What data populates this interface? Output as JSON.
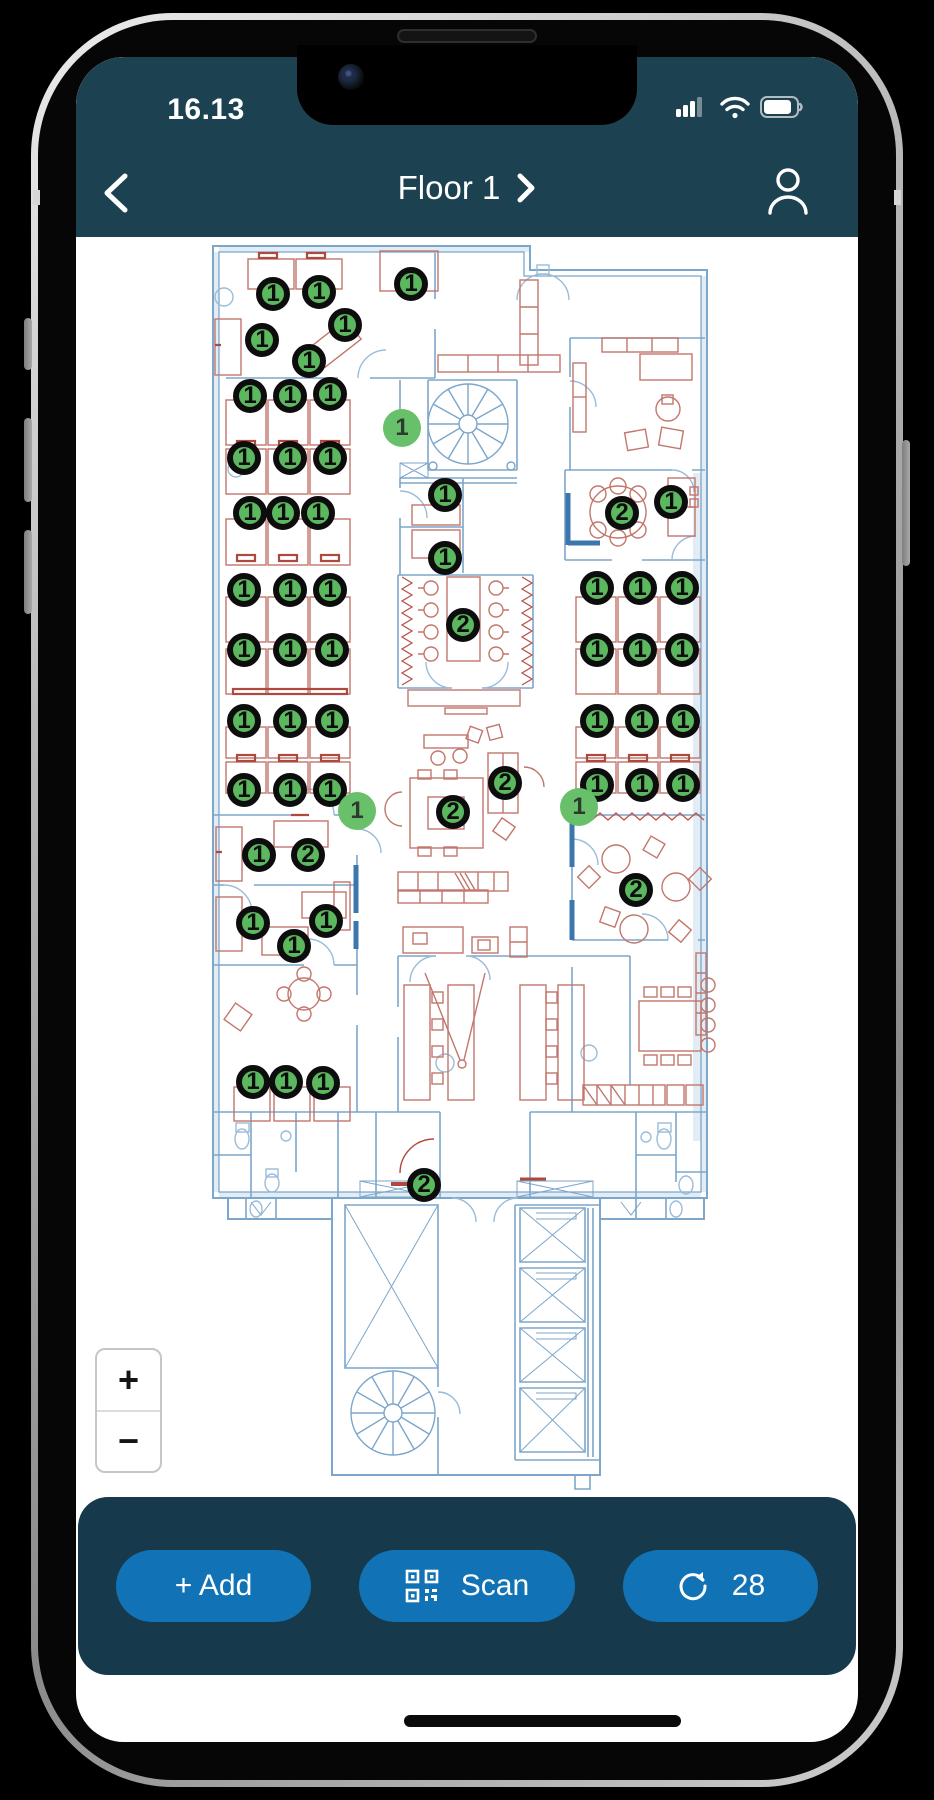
{
  "status_bar": {
    "time": "16.13",
    "cellular_bars": 3,
    "battery_percent": 80
  },
  "header": {
    "title": "Floor 1"
  },
  "map": {
    "zoom_in": "+",
    "zoom_out": "−",
    "markers": [
      {
        "x": 197,
        "y": 57,
        "label": "1",
        "variant": "ring"
      },
      {
        "x": 243,
        "y": 55,
        "label": "1",
        "variant": "ring"
      },
      {
        "x": 335,
        "y": 47,
        "label": "1",
        "variant": "ring"
      },
      {
        "x": 186,
        "y": 103,
        "label": "1",
        "variant": "ring"
      },
      {
        "x": 269,
        "y": 88,
        "label": "1",
        "variant": "ring"
      },
      {
        "x": 233,
        "y": 124,
        "label": "1",
        "variant": "ring"
      },
      {
        "x": 174,
        "y": 159,
        "label": "1",
        "variant": "ring"
      },
      {
        "x": 214,
        "y": 159,
        "label": "1",
        "variant": "ring"
      },
      {
        "x": 254,
        "y": 157,
        "label": "1",
        "variant": "ring"
      },
      {
        "x": 168,
        "y": 221,
        "label": "1",
        "variant": "ring"
      },
      {
        "x": 214,
        "y": 221,
        "label": "1",
        "variant": "ring"
      },
      {
        "x": 254,
        "y": 221,
        "label": "1",
        "variant": "ring"
      },
      {
        "x": 174,
        "y": 276,
        "label": "1",
        "variant": "ring"
      },
      {
        "x": 207,
        "y": 276,
        "label": "1",
        "variant": "ring"
      },
      {
        "x": 242,
        "y": 276,
        "label": "1",
        "variant": "ring"
      },
      {
        "x": 326,
        "y": 191,
        "label": "1",
        "variant": "plain"
      },
      {
        "x": 369,
        "y": 258,
        "label": "1",
        "variant": "ring"
      },
      {
        "x": 369,
        "y": 321,
        "label": "1",
        "variant": "ring"
      },
      {
        "x": 546,
        "y": 276,
        "label": "2",
        "variant": "ring"
      },
      {
        "x": 595,
        "y": 265,
        "label": "1",
        "variant": "ring"
      },
      {
        "x": 168,
        "y": 353,
        "label": "1",
        "variant": "ring"
      },
      {
        "x": 214,
        "y": 353,
        "label": "1",
        "variant": "ring"
      },
      {
        "x": 254,
        "y": 353,
        "label": "1",
        "variant": "ring"
      },
      {
        "x": 521,
        "y": 351,
        "label": "1",
        "variant": "ring"
      },
      {
        "x": 564,
        "y": 351,
        "label": "1",
        "variant": "ring"
      },
      {
        "x": 606,
        "y": 351,
        "label": "1",
        "variant": "ring"
      },
      {
        "x": 168,
        "y": 413,
        "label": "1",
        "variant": "ring"
      },
      {
        "x": 214,
        "y": 413,
        "label": "1",
        "variant": "ring"
      },
      {
        "x": 256,
        "y": 413,
        "label": "1",
        "variant": "ring"
      },
      {
        "x": 521,
        "y": 413,
        "label": "1",
        "variant": "ring"
      },
      {
        "x": 564,
        "y": 413,
        "label": "1",
        "variant": "ring"
      },
      {
        "x": 606,
        "y": 413,
        "label": "1",
        "variant": "ring"
      },
      {
        "x": 387,
        "y": 388,
        "label": "2",
        "variant": "ring"
      },
      {
        "x": 168,
        "y": 484,
        "label": "1",
        "variant": "ring"
      },
      {
        "x": 214,
        "y": 484,
        "label": "1",
        "variant": "ring"
      },
      {
        "x": 256,
        "y": 484,
        "label": "1",
        "variant": "ring"
      },
      {
        "x": 521,
        "y": 484,
        "label": "1",
        "variant": "ring"
      },
      {
        "x": 566,
        "y": 484,
        "label": "1",
        "variant": "ring"
      },
      {
        "x": 607,
        "y": 484,
        "label": "1",
        "variant": "ring"
      },
      {
        "x": 168,
        "y": 553,
        "label": "1",
        "variant": "ring"
      },
      {
        "x": 214,
        "y": 553,
        "label": "1",
        "variant": "ring"
      },
      {
        "x": 254,
        "y": 553,
        "label": "1",
        "variant": "ring"
      },
      {
        "x": 521,
        "y": 548,
        "label": "1",
        "variant": "ring"
      },
      {
        "x": 566,
        "y": 548,
        "label": "1",
        "variant": "ring"
      },
      {
        "x": 607,
        "y": 548,
        "label": "1",
        "variant": "ring"
      },
      {
        "x": 429,
        "y": 546,
        "label": "2",
        "variant": "ring"
      },
      {
        "x": 377,
        "y": 575,
        "label": "2",
        "variant": "ring"
      },
      {
        "x": 281,
        "y": 574,
        "label": "1",
        "variant": "plain"
      },
      {
        "x": 503,
        "y": 570,
        "label": "1",
        "variant": "plain"
      },
      {
        "x": 183,
        "y": 618,
        "label": "1",
        "variant": "ring"
      },
      {
        "x": 232,
        "y": 618,
        "label": "2",
        "variant": "ring"
      },
      {
        "x": 560,
        "y": 653,
        "label": "2",
        "variant": "ring"
      },
      {
        "x": 177,
        "y": 686,
        "label": "1",
        "variant": "ring"
      },
      {
        "x": 250,
        "y": 684,
        "label": "1",
        "variant": "ring"
      },
      {
        "x": 218,
        "y": 709,
        "label": "1",
        "variant": "ring"
      },
      {
        "x": 177,
        "y": 845,
        "label": "1",
        "variant": "ring"
      },
      {
        "x": 210,
        "y": 845,
        "label": "1",
        "variant": "ring"
      },
      {
        "x": 247,
        "y": 846,
        "label": "1",
        "variant": "ring"
      },
      {
        "x": 348,
        "y": 948,
        "label": "2",
        "variant": "ring"
      }
    ]
  },
  "toolbar": {
    "add": "+ Add",
    "scan": "Scan",
    "sync_count": "28"
  },
  "colors": {
    "header_bg": "#1c4151",
    "toolbar_bg": "#16394b",
    "button_bg": "#1173b5",
    "marker_green": "#5cb85f",
    "marker_green_light": "#68c06a",
    "plan_wall": "#7ca6ca",
    "plan_furniture": "#c2766c"
  }
}
